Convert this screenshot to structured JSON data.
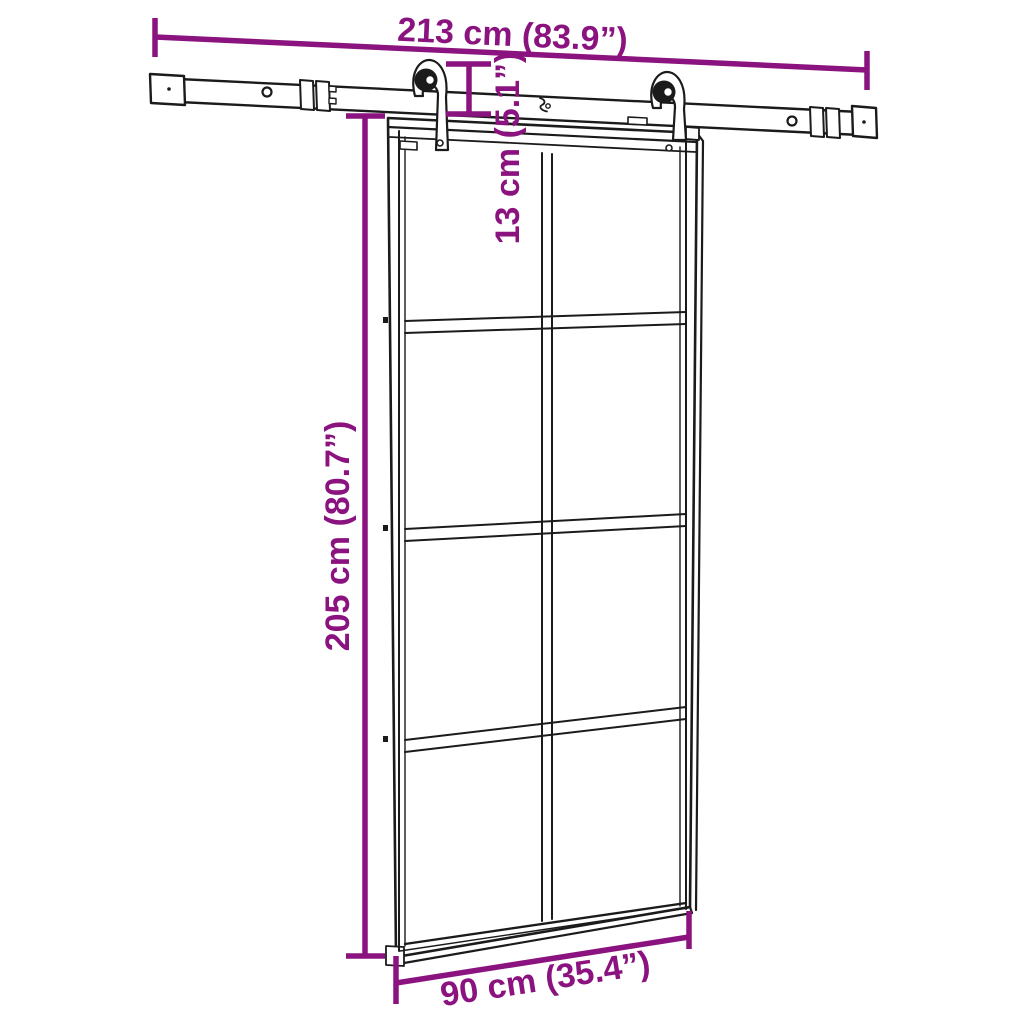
{
  "page": {
    "background": "#ffffff"
  },
  "colors": {
    "accent": "#8B137F",
    "line": "#1b1b1b",
    "fill": "#ffffff"
  },
  "diagram": {
    "subject": "Sliding barn door with 8 glass panels and overhead sliding hardware rail",
    "dimensions": {
      "rail_width": {
        "cm": 213,
        "inch": 83.9,
        "label": "213 cm (83.9”)"
      },
      "drop": {
        "cm": 13,
        "inch": 5.1,
        "label": "13 cm (5.1”)"
      },
      "door_height": {
        "cm": 205,
        "inch": 80.7,
        "label": "205 cm (80.7”)"
      },
      "door_width": {
        "cm": 90,
        "inch": 35.4,
        "label": "90 cm (35.4”)"
      }
    }
  }
}
